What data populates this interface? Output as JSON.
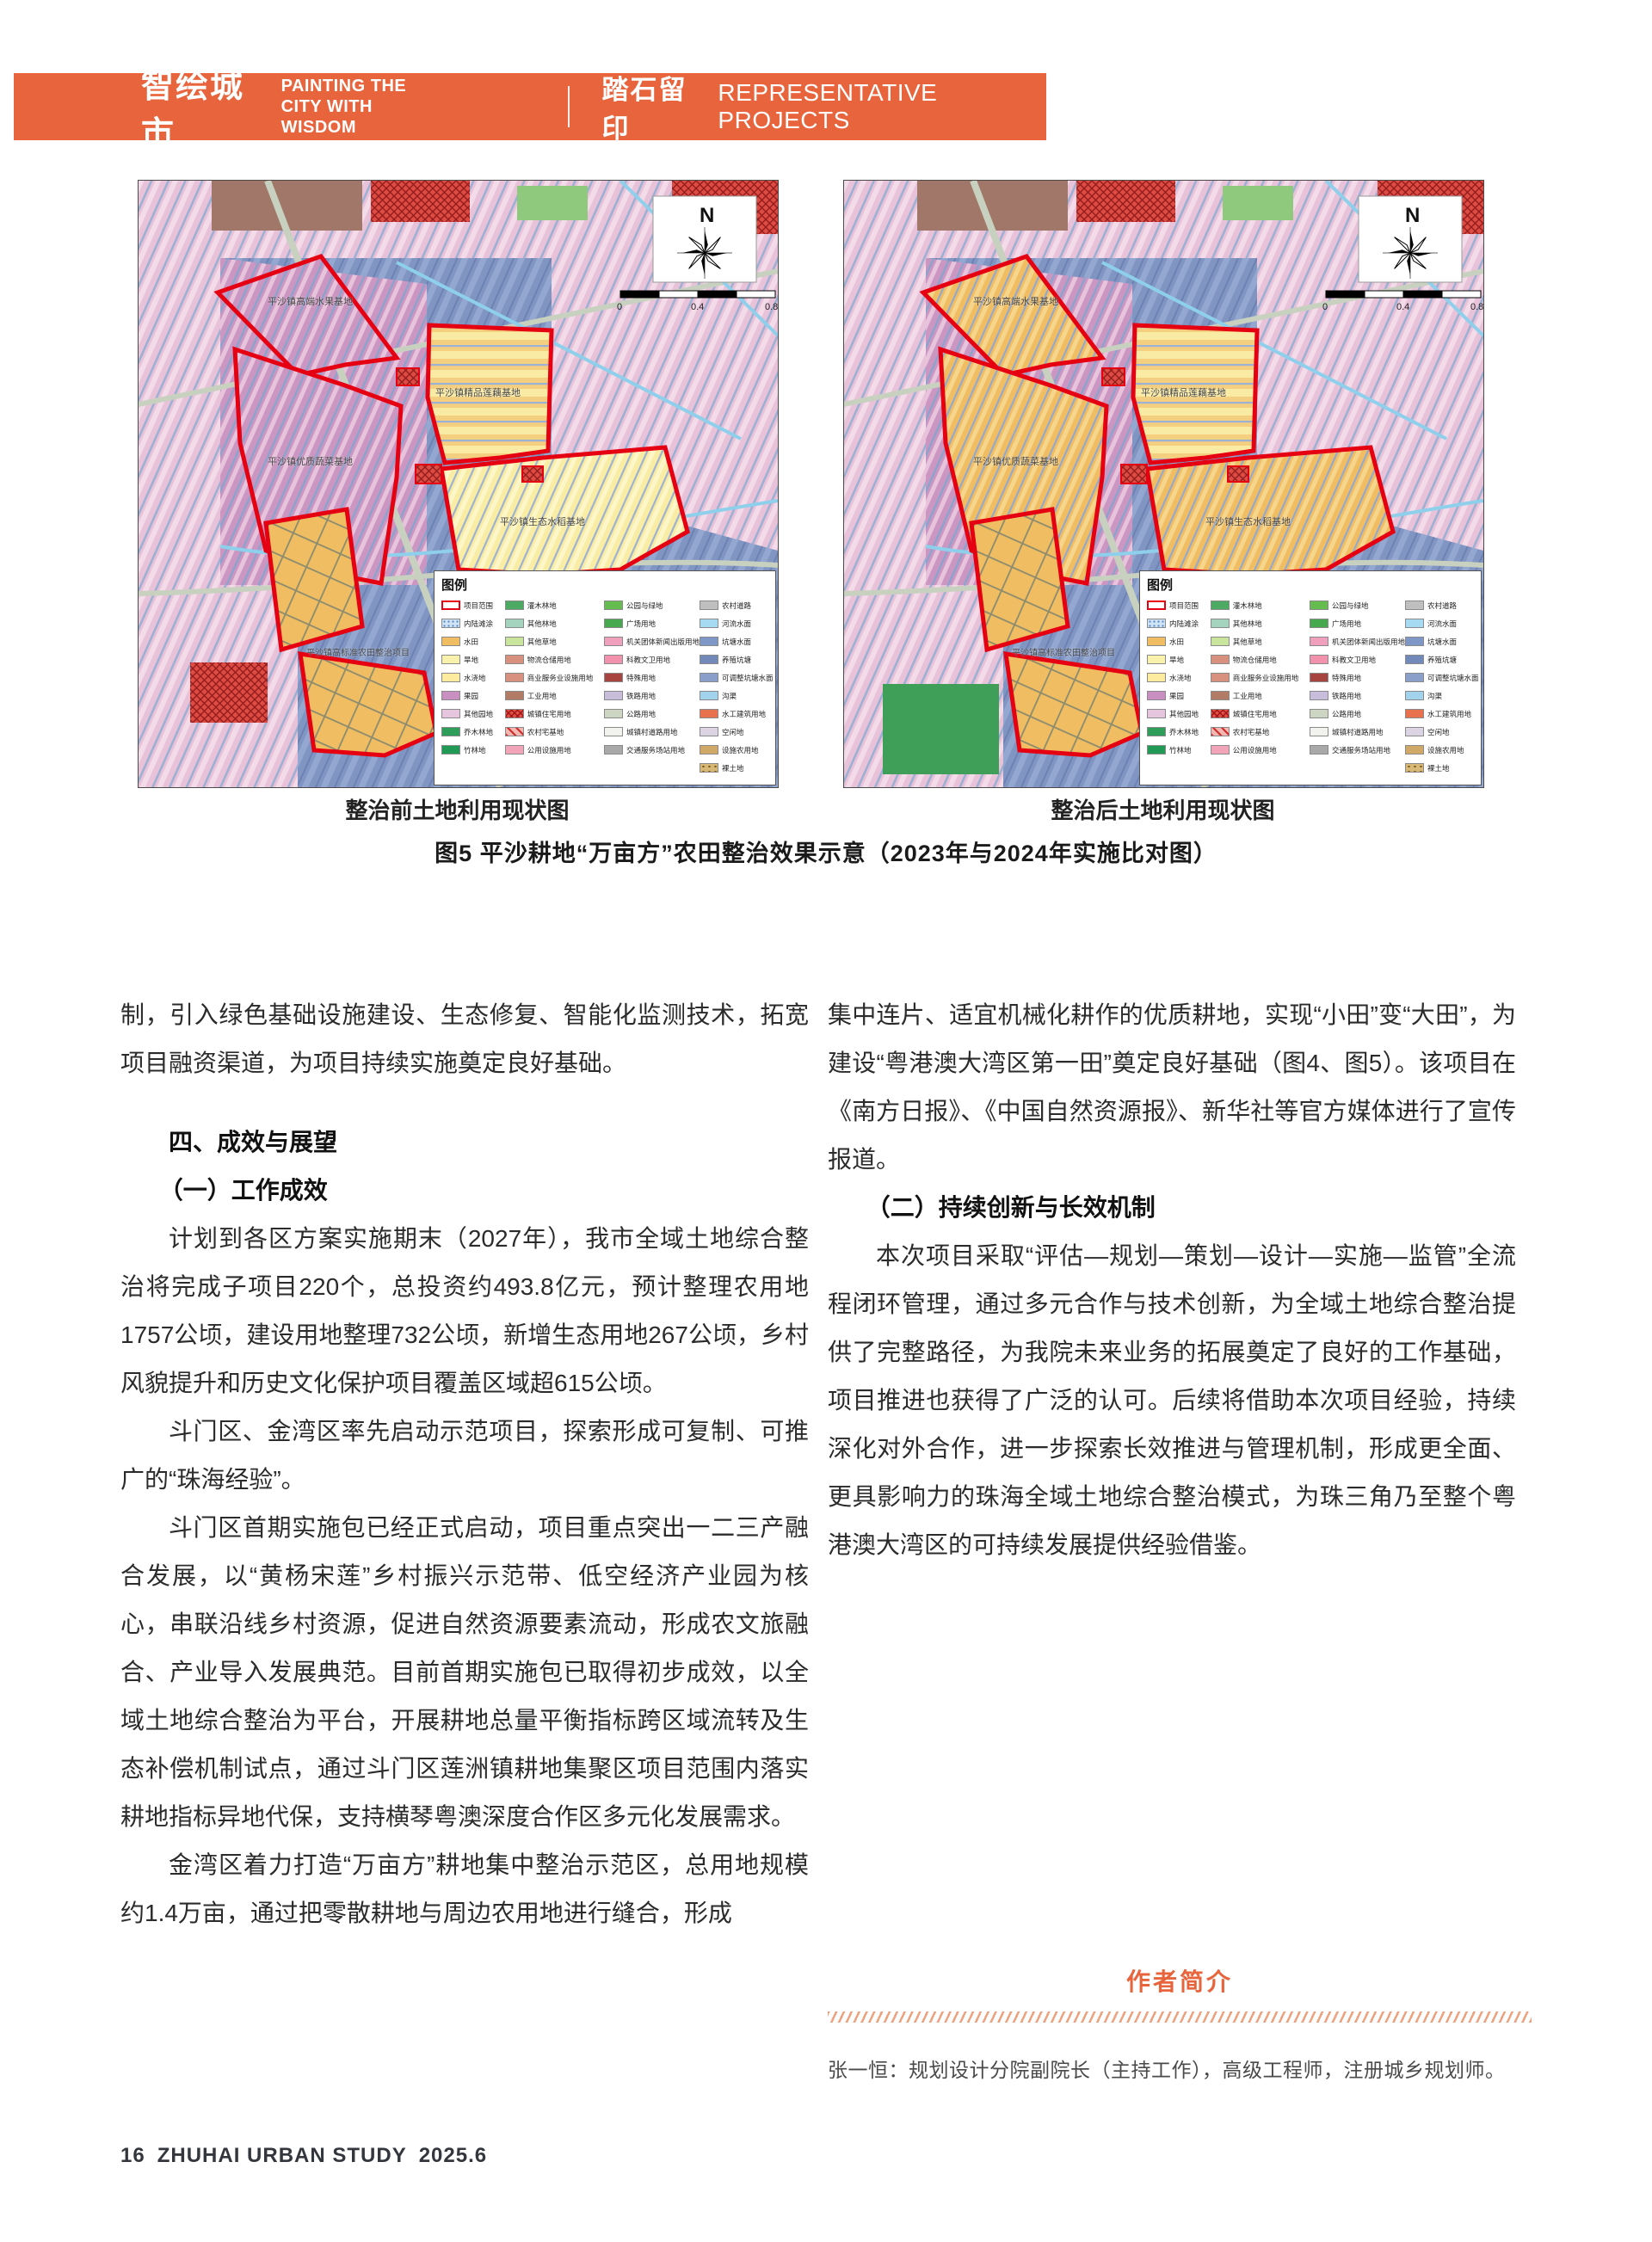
{
  "header": {
    "brand_cn": "智绘城市",
    "brand_en_line1": "PAINTING THE",
    "brand_en_line2": "CITY WITH WISDOM",
    "section_cn": "踏石留印",
    "section_en": "REPRESENTATIVE PROJECTS",
    "accent_color": "#E8643C"
  },
  "figure": {
    "caption_left": "整治前土地利用现状图",
    "caption_right": "整治后土地利用现状图",
    "figure_caption": "图5 平沙耕地“万亩方”农田整治效果示意（2023年与2024年实施比对图）",
    "map": {
      "north_label": "N",
      "scale_ticks": [
        "0",
        "0.4",
        "0.8"
      ],
      "legend_title": "图例",
      "labels": [
        "平沙镇高端水果基地",
        "平沙镇精品莲藕基地",
        "平沙镇优质蔬菜基地",
        "平沙镇生态水稻基地",
        "平沙镇高标准农田整治项目"
      ],
      "boundary_color": "#e50012",
      "water_color": "#8095c2",
      "legend": {
        "col1": [
          {
            "label": "项目范围",
            "color": "#ffffff",
            "style": "outline"
          },
          {
            "label": "内陆滩涂",
            "color": "#cfe3f5",
            "style": "dots"
          },
          {
            "label": "水田",
            "color": "#f0bd62"
          },
          {
            "label": "旱地",
            "color": "#f8f2ac"
          },
          {
            "label": "水浇地",
            "color": "#fdeca0"
          },
          {
            "label": "果园",
            "color": "#c88fc0"
          },
          {
            "label": "其他园地",
            "color": "#e6c6df"
          },
          {
            "label": "乔木林地",
            "color": "#2f9e5b"
          },
          {
            "label": "竹林地",
            "color": "#219a55"
          }
        ],
        "col2": [
          {
            "label": "灌木林地",
            "color": "#4daa62"
          },
          {
            "label": "其他林地",
            "color": "#a5d4be"
          },
          {
            "label": "其他草地",
            "color": "#c9e59d"
          },
          {
            "label": "物流仓储用地",
            "color": "#d8907f"
          },
          {
            "label": "商业服务业设施用地",
            "color": "#d8917f"
          },
          {
            "label": "工业用地",
            "color": "#b27b66"
          },
          {
            "label": "城镇住宅用地",
            "color": "#e05045",
            "style": "crosshatch"
          },
          {
            "label": "农村宅基地",
            "color": "#f2b7b1",
            "style": "diag"
          },
          {
            "label": "公用设施用地",
            "color": "#f2a4b8"
          }
        ],
        "col3": [
          {
            "label": "公园与绿地",
            "color": "#66bd4f"
          },
          {
            "label": "广场用地",
            "color": "#46a94e"
          },
          {
            "label": "机关团体新闻出版用地",
            "color": "#f0a0bd"
          },
          {
            "label": "科教文卫用地",
            "color": "#f292ad"
          },
          {
            "label": "特殊用地",
            "color": "#a8443f"
          },
          {
            "label": "铁路用地",
            "color": "#c9bddc"
          },
          {
            "label": "公路用地",
            "color": "#cdd6c3"
          },
          {
            "label": "城镇村道路用地",
            "color": "#f2f2ef"
          },
          {
            "label": "交通服务场站用地",
            "color": "#a9a9a9"
          }
        ],
        "col4": [
          {
            "label": "农村道路",
            "color": "#bfbfbf"
          },
          {
            "label": "河流水面",
            "color": "#a6daf2"
          },
          {
            "label": "坑塘水面",
            "color": "#7e97c6"
          },
          {
            "label": "养殖坑塘",
            "color": "#7389ba"
          },
          {
            "label": "可调整坑塘水面",
            "color": "#8aa0cb"
          },
          {
            "label": "沟渠",
            "color": "#a3d2ec"
          },
          {
            "label": "水工建筑用地",
            "color": "#e8714e"
          },
          {
            "label": "空闲地",
            "color": "#dcd4e2"
          },
          {
            "label": "设施农用地",
            "color": "#d0a868"
          },
          {
            "label": "裸土地",
            "color": "#d8b878",
            "style": "bare"
          }
        ]
      }
    }
  },
  "article": {
    "left_column": {
      "para_continued": "制，引入绿色基础设施建设、生态修复、智能化监测技术，拓宽项目融资渠道，为项目持续实施奠定良好基础。",
      "heading_section": "四、成效与展望",
      "heading_sub1": "（一）工作成效",
      "para1": "计划到各区方案实施期末（2027年），我市全域土地综合整治将完成子项目220个，总投资约493.8亿元，预计整理农用地1757公顷，建设用地整理732公顷，新增生态用地267公顷，乡村风貌提升和历史文化保护项目覆盖区域超615公顷。",
      "para2": "斗门区、金湾区率先启动示范项目，探索形成可复制、可推广的“珠海经验”。",
      "para3": "斗门区首期实施包已经正式启动，项目重点突出一二三产融合发展，以“黄杨宋莲”乡村振兴示范带、低空经济产业园为核心，串联沿线乡村资源，促进自然资源要素流动，形成农文旅融合、产业导入发展典范。目前首期实施包已取得初步成效，以全域土地综合整治为平台，开展耕地总量平衡指标跨区域流转及生态补偿机制试点，通过斗门区莲洲镇耕地集聚区项目范围内落实耕地指标异地代保，支持横琴粤澳深度合作区多元化发展需求。",
      "para4": "金湾区着力打造“万亩方”耕地集中整治示范区，总用地规模约1.4万亩，通过把零散耕地与周边农用地进行缝合，形成"
    },
    "right_column": {
      "para_continued": "集中连片、适宜机械化耕作的优质耕地，实现“小田”变“大田”，为建设“粤港澳大湾区第一田”奠定良好基础（图4、图5）。该项目在《南方日报》、《中国自然资源报》、新华社等官方媒体进行了宣传报道。",
      "heading_sub2": "（二）持续创新与长效机制",
      "para1": "本次项目采取“评估—规划—策划—设计—实施—监管”全流程闭环管理，通过多元合作与技术创新，为全域土地综合整治提供了完整路径，为我院未来业务的拓展奠定了良好的工作基础，项目推进也获得了广泛的认可。后续将借助本次项目经验，持续深化对外合作，进一步探索长效推进与管理机制，形成更全面、更具影响力的珠海全域土地综合整治模式，为珠三角乃至整个粤港澳大湾区的可持续发展提供经验借鉴。"
    }
  },
  "author": {
    "title": "作者简介",
    "bio": "张一恒：规划设计分院副院长（主持工作），高级工程师，注册城乡规划师。"
  },
  "footer": {
    "page_number": "16",
    "journal": "ZHUHAI URBAN STUDY",
    "issue": "2025.6"
  }
}
